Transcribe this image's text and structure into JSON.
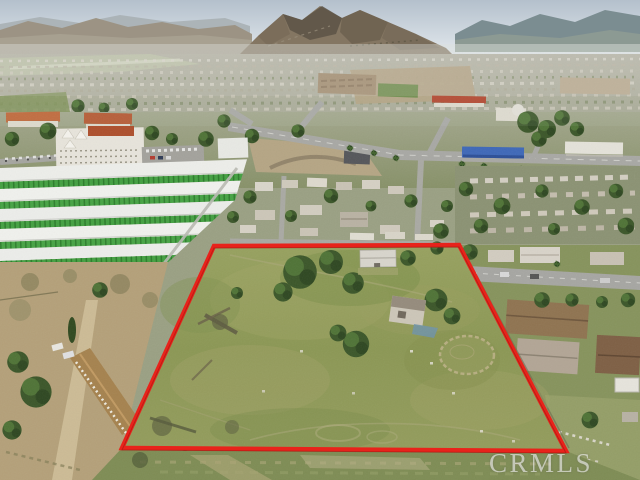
{
  "watermark": {
    "text": "CRMLS"
  },
  "colors": {
    "boundary_red": "#e8231b",
    "watermark_white": "#f5f5f3",
    "sky_top": "#b4c0cc",
    "sky_bottom": "#e9edf0",
    "mountain_brown": "#847662",
    "distant_hills_blue": "#7b8d91",
    "field_green": "#8f9a58",
    "tree_green": "#3b5629",
    "storage_door_green": "#43a041",
    "storage_roof_white": "#edeeea",
    "dirt_tan": "#b4a079",
    "road_gray": "#a8a8a4",
    "tile_roof_orange": "#bf6436",
    "commercial_blue": "#3e68b8"
  },
  "scene": {
    "type": "aerial-photograph",
    "subject": "vacant land parcel outlined in red",
    "regions": [
      "sky",
      "mountains",
      "valley-sprawl",
      "town",
      "storage-facility",
      "mid-block",
      "left-farm-area",
      "subject-lot",
      "neighborhood-right",
      "bottom-strip",
      "property-boundary",
      "watermark"
    ]
  }
}
